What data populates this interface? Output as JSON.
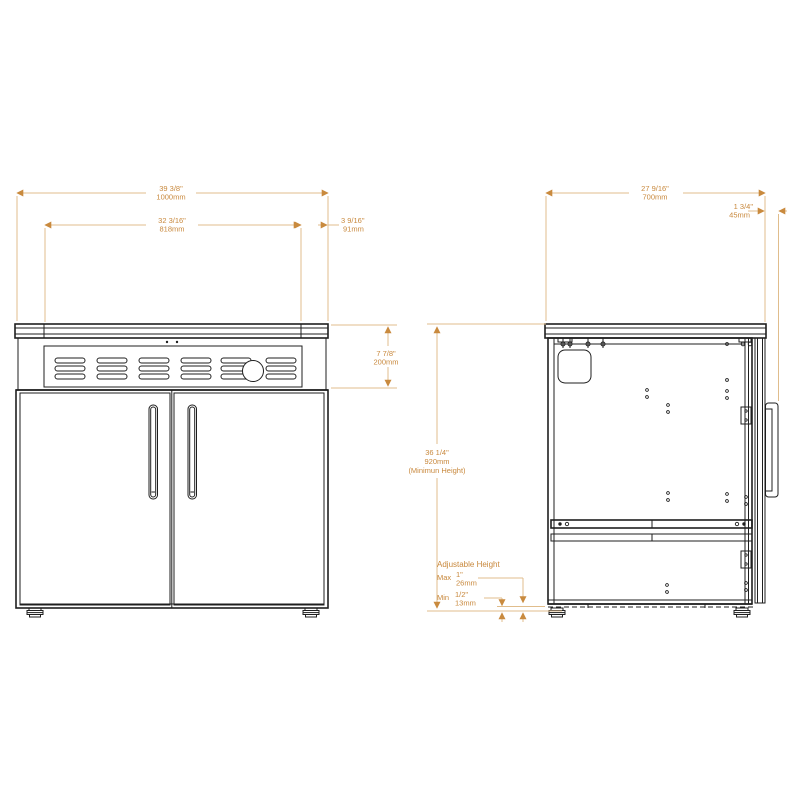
{
  "drawing": {
    "kind_note": "appliance installation dimension drawing, front and side elevation",
    "colors": {
      "background": "#ffffff",
      "line_art": "#1f1f1f",
      "dimension_line": "#e0bd8c",
      "dimension_text": "#c8883c",
      "arrow": "#c98a3e"
    }
  },
  "front_view": {
    "dim_width_total": {
      "inches": "39 3/8\"",
      "mm": "1000mm"
    },
    "dim_width_vent": {
      "inches": "32 3/16\"",
      "mm": "818mm"
    },
    "dim_width_side": {
      "inches": "3 9/16\"",
      "mm": "91mm"
    },
    "dim_height_hood": {
      "inches": "7 7/8\"",
      "mm": "200mm"
    }
  },
  "side_view": {
    "dim_depth": {
      "inches": "27 9/16\"",
      "mm": "700mm"
    },
    "dim_handle": {
      "inches": "1 3/4\"",
      "mm": "45mm"
    },
    "dim_height": {
      "inches": "36 1/4\"",
      "mm": "920mm",
      "note": "(Minimun Height)"
    }
  },
  "adjustable_height": {
    "title": "Adjustable Height",
    "max_label": "Max",
    "max_inches": "1\"",
    "max_mm": "26mm",
    "min_label": "Min",
    "min_inches": "1/2\"",
    "min_mm": "13mm"
  }
}
